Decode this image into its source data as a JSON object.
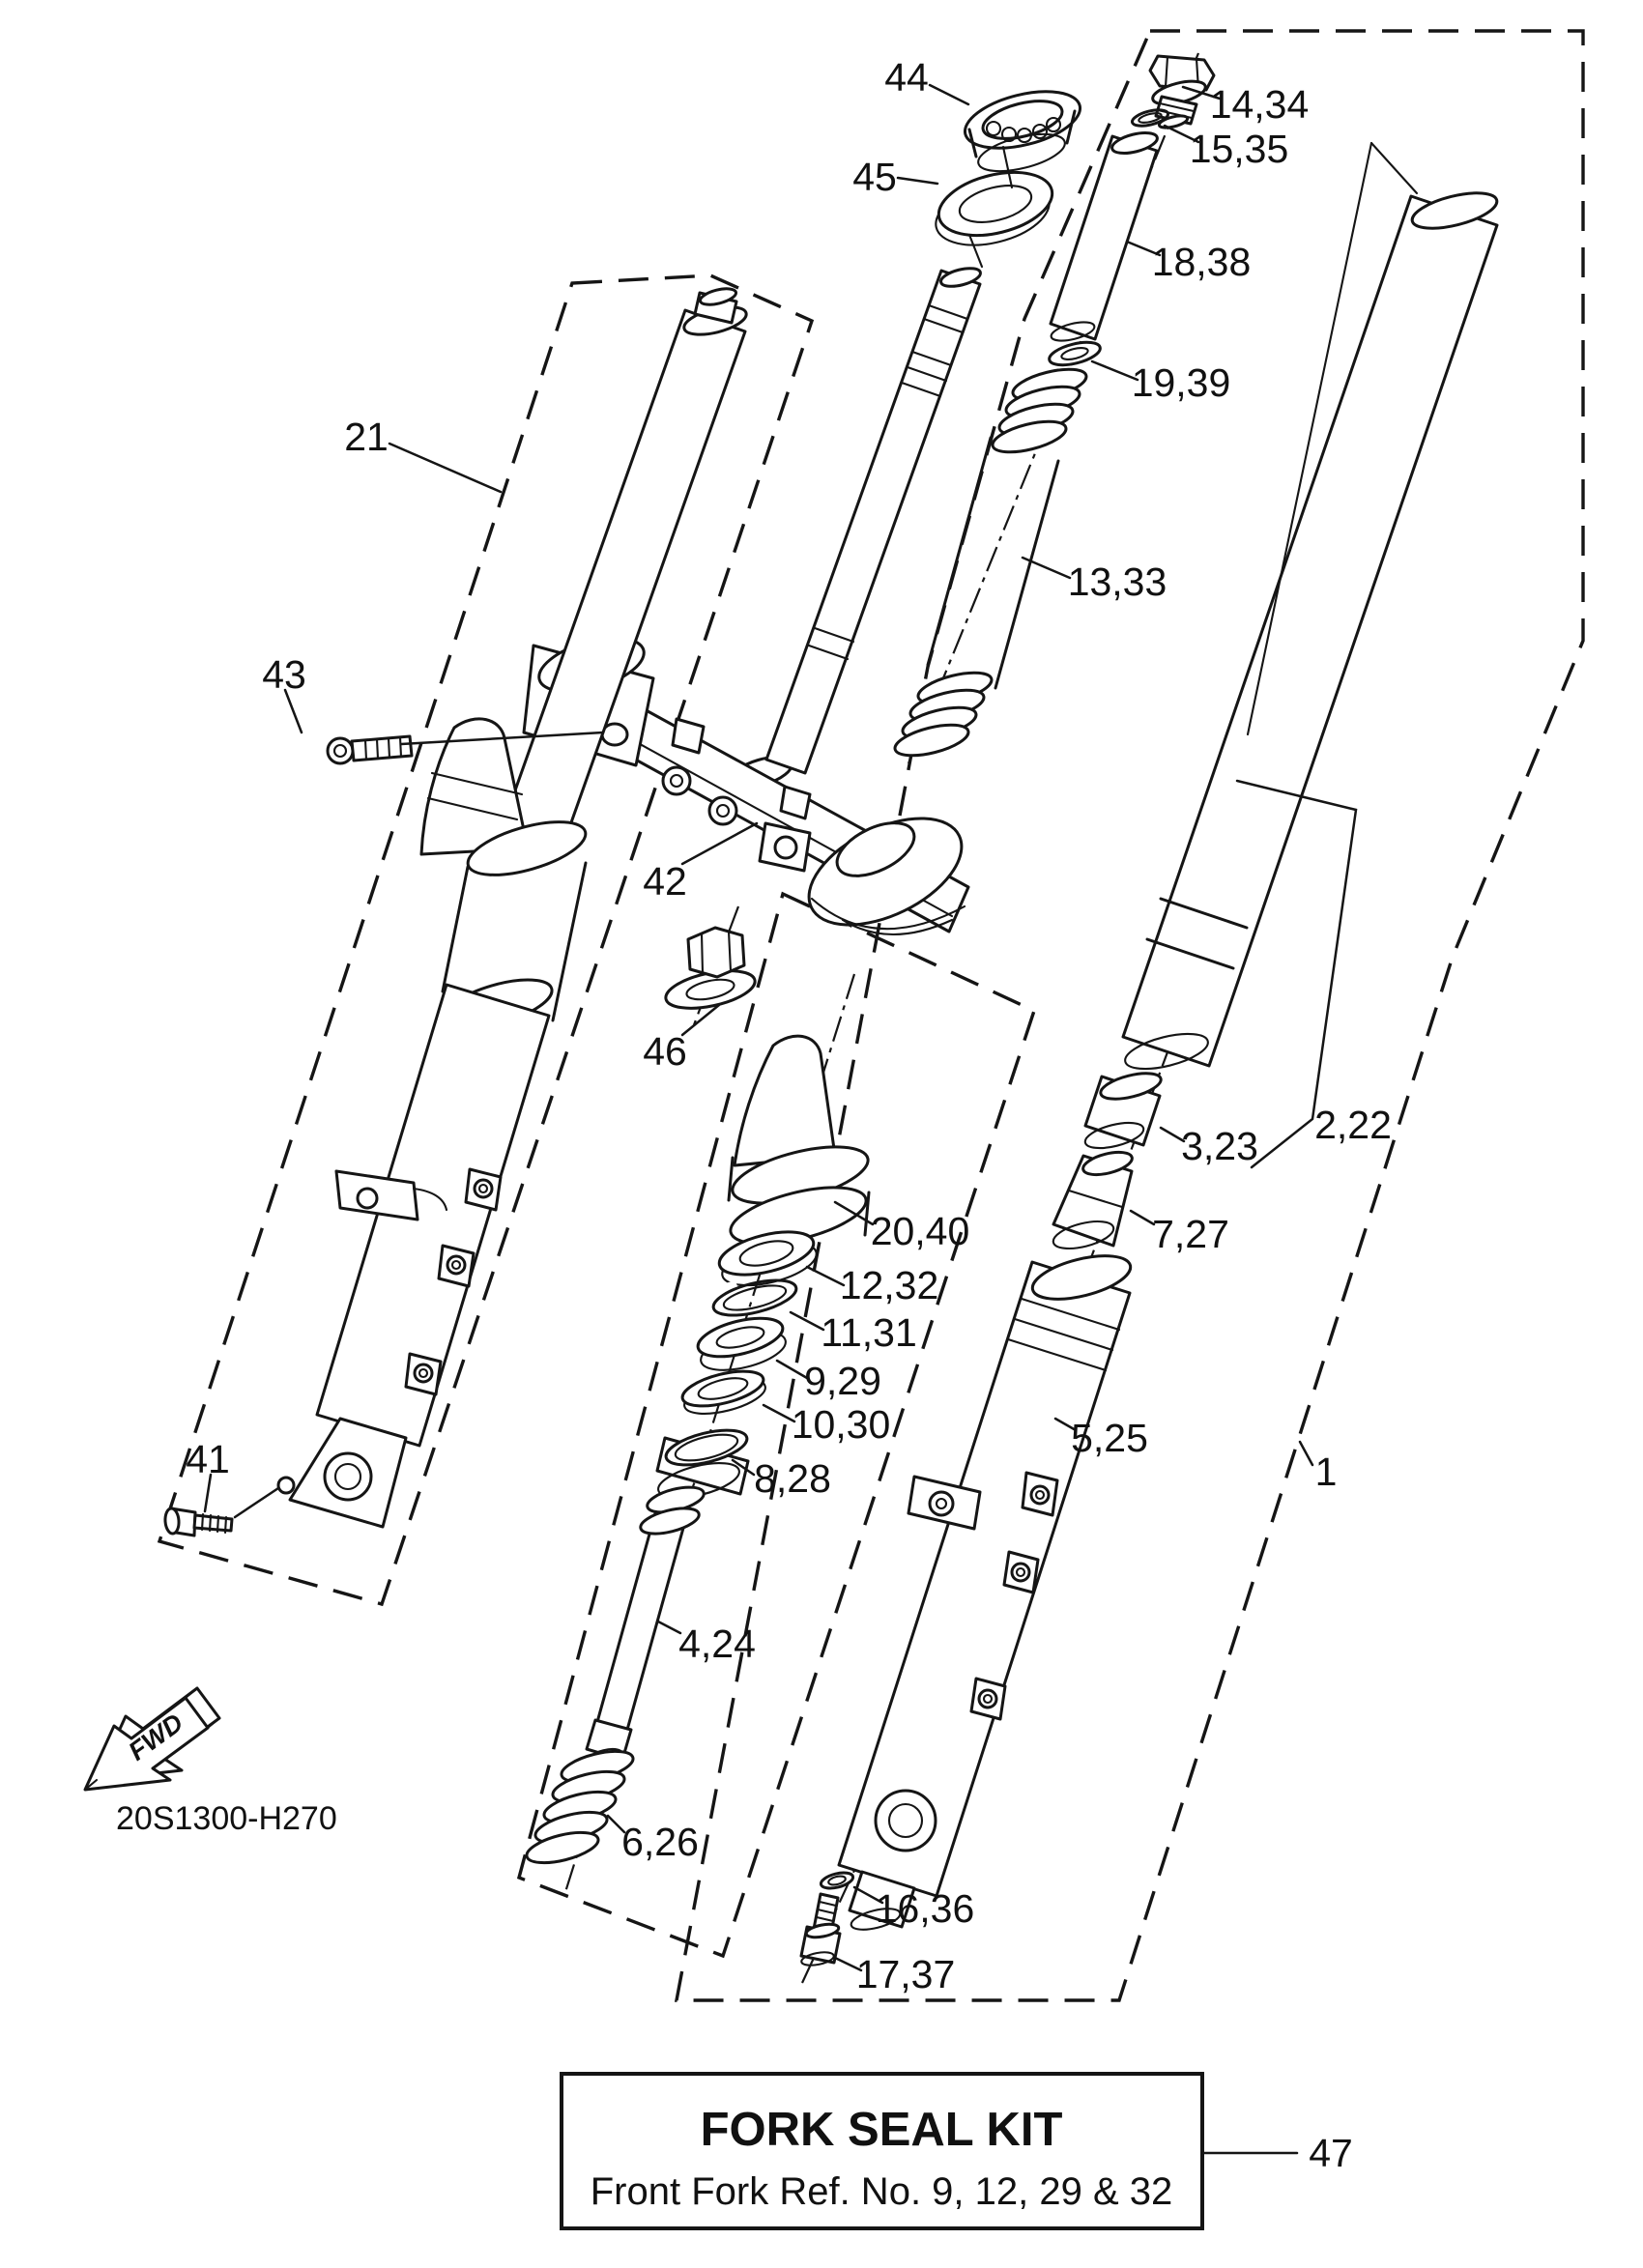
{
  "diagram": {
    "drawing_code": "20S1300-H270",
    "fwd_label": "FWD",
    "kit_box": {
      "title": "FORK SEAL KIT",
      "subtitle": "Front Fork Ref. No. 9, 12, 29 & 32"
    },
    "callouts": [
      {
        "id": "44",
        "text": "44"
      },
      {
        "id": "45",
        "text": "45"
      },
      {
        "id": "14-34",
        "text": "14,34"
      },
      {
        "id": "15-35",
        "text": "15,35"
      },
      {
        "id": "18-38",
        "text": "18,38"
      },
      {
        "id": "19-39",
        "text": "19,39"
      },
      {
        "id": "13-33",
        "text": "13,33"
      },
      {
        "id": "21",
        "text": "21"
      },
      {
        "id": "43",
        "text": "43"
      },
      {
        "id": "42",
        "text": "42"
      },
      {
        "id": "46",
        "text": "46"
      },
      {
        "id": "20-40",
        "text": "20,40"
      },
      {
        "id": "12-32",
        "text": "12,32"
      },
      {
        "id": "11-31",
        "text": "11,31"
      },
      {
        "id": "9-29",
        "text": "9,29"
      },
      {
        "id": "10-30",
        "text": "10,30"
      },
      {
        "id": "8-28",
        "text": "8,28"
      },
      {
        "id": "2-22",
        "text": "2,22"
      },
      {
        "id": "3-23",
        "text": "3,23"
      },
      {
        "id": "7-27",
        "text": "7,27"
      },
      {
        "id": "5-25",
        "text": "5,25"
      },
      {
        "id": "1",
        "text": "1"
      },
      {
        "id": "41",
        "text": "41"
      },
      {
        "id": "4-24",
        "text": "4,24"
      },
      {
        "id": "6-26",
        "text": "6,26"
      },
      {
        "id": "16-36",
        "text": "16,36"
      },
      {
        "id": "17-37",
        "text": "17,37"
      },
      {
        "id": "47",
        "text": "47"
      }
    ]
  }
}
